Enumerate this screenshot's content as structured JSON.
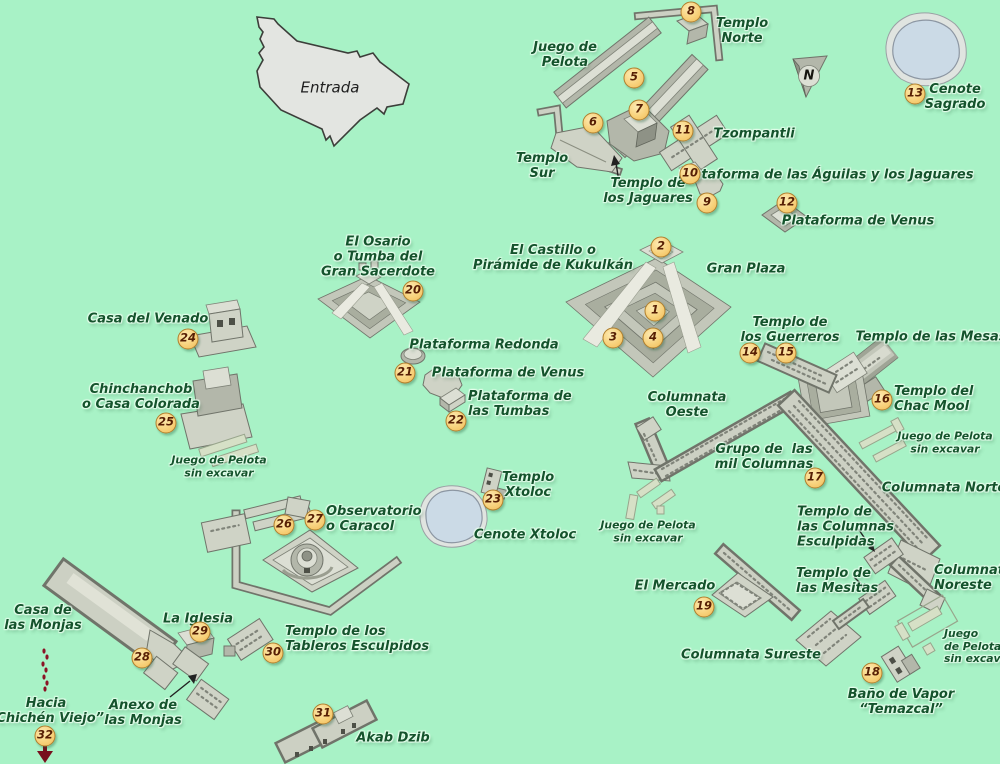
{
  "map": {
    "title": "Chichén Itzá archaeological site map",
    "background_color": "#a8f2c6",
    "label_color": "#14532c",
    "badge": {
      "fill": "#f8d27c",
      "border": "#b07f2e",
      "text_color": "#571f04"
    },
    "compass": {
      "letter": "N",
      "x": 809,
      "y": 76
    },
    "markers": [
      {
        "n": "1",
        "x": 655,
        "y": 311
      },
      {
        "n": "2",
        "x": 661,
        "y": 247
      },
      {
        "n": "3",
        "x": 613,
        "y": 338
      },
      {
        "n": "4",
        "x": 653,
        "y": 338
      },
      {
        "n": "5",
        "x": 634,
        "y": 78
      },
      {
        "n": "6",
        "x": 593,
        "y": 123
      },
      {
        "n": "7",
        "x": 639,
        "y": 110
      },
      {
        "n": "8",
        "x": 691,
        "y": 12
      },
      {
        "n": "9",
        "x": 707,
        "y": 203
      },
      {
        "n": "10",
        "x": 690,
        "y": 174
      },
      {
        "n": "11",
        "x": 683,
        "y": 131
      },
      {
        "n": "12",
        "x": 787,
        "y": 203
      },
      {
        "n": "13",
        "x": 915,
        "y": 94
      },
      {
        "n": "14",
        "x": 750,
        "y": 353
      },
      {
        "n": "15",
        "x": 786,
        "y": 353
      },
      {
        "n": "16",
        "x": 882,
        "y": 400
      },
      {
        "n": "17",
        "x": 815,
        "y": 478
      },
      {
        "n": "18",
        "x": 872,
        "y": 673
      },
      {
        "n": "19",
        "x": 704,
        "y": 607
      },
      {
        "n": "20",
        "x": 413,
        "y": 291
      },
      {
        "n": "21",
        "x": 405,
        "y": 373
      },
      {
        "n": "22",
        "x": 456,
        "y": 421
      },
      {
        "n": "23",
        "x": 493,
        "y": 500
      },
      {
        "n": "24",
        "x": 188,
        "y": 339
      },
      {
        "n": "25",
        "x": 166,
        "y": 423
      },
      {
        "n": "26",
        "x": 284,
        "y": 525
      },
      {
        "n": "27",
        "x": 315,
        "y": 520
      },
      {
        "n": "28",
        "x": 142,
        "y": 658
      },
      {
        "n": "29",
        "x": 200,
        "y": 632
      },
      {
        "n": "30",
        "x": 273,
        "y": 653
      },
      {
        "n": "31",
        "x": 323,
        "y": 714
      },
      {
        "n": "32",
        "x": 45,
        "y": 736
      }
    ],
    "labels": [
      {
        "id": "entrada",
        "text": "Entrada",
        "x": 330,
        "y": 88,
        "style": "plain"
      },
      {
        "id": "juego-de-pelota",
        "text": "Juego de\nPelota",
        "x": 565,
        "y": 55
      },
      {
        "id": "templo-norte",
        "text": "Templo\nNorte",
        "x": 742,
        "y": 31
      },
      {
        "id": "templo-sur",
        "text": "Templo\nSur",
        "x": 542,
        "y": 166
      },
      {
        "id": "templo-de-los-jaguares",
        "text": "Templo de\nlos Jaguares",
        "x": 648,
        "y": 191
      },
      {
        "id": "tzompantli",
        "text": "Tzompantli",
        "x": 754,
        "y": 134
      },
      {
        "id": "plataforma-aguilas-jaguares",
        "text": "Plataforma de las Águilas y los Jaguares",
        "x": 826,
        "y": 175
      },
      {
        "id": "plataforma-de-venus-norte",
        "text": "Plataforma de Venus",
        "x": 858,
        "y": 221
      },
      {
        "id": "cenote-sagrado",
        "text": "Cenote\nSagrado",
        "x": 955,
        "y": 97
      },
      {
        "id": "el-castillo",
        "text": "El Castillo o\nPirámide de Kukulkán",
        "x": 553,
        "y": 258
      },
      {
        "id": "gran-plaza",
        "text": "Gran Plaza",
        "x": 746,
        "y": 269
      },
      {
        "id": "el-osario",
        "text": "El Osario\no Tumba del\nGran Sacerdote",
        "x": 378,
        "y": 257
      },
      {
        "id": "casa-del-venado",
        "text": "Casa del Venado",
        "x": 148,
        "y": 319
      },
      {
        "id": "chinchanchob",
        "text": "Chinchanchob\no Casa Colorada",
        "x": 141,
        "y": 397
      },
      {
        "id": "juego-sin-excavar-oeste",
        "text": "Juego de Pelota\nsin excavar",
        "x": 219,
        "y": 467,
        "size": "small"
      },
      {
        "id": "plataforma-redonda",
        "text": "Plataforma Redonda",
        "x": 484,
        "y": 345
      },
      {
        "id": "plataforma-de-venus-centro",
        "text": "Plataforma de Venus",
        "x": 508,
        "y": 373
      },
      {
        "id": "plataforma-de-las-tumbas",
        "text": "Plataforma de\nlas Tumbas",
        "x": 468,
        "y": 404,
        "align": "left"
      },
      {
        "id": "templo-xtoloc",
        "text": "Templo\nXtoloc",
        "x": 528,
        "y": 485
      },
      {
        "id": "cenote-xtoloc",
        "text": "Cenote Xtoloc",
        "x": 525,
        "y": 535
      },
      {
        "id": "templo-de-los-guerreros",
        "text": "Templo de\nlos Guerreros",
        "x": 790,
        "y": 330
      },
      {
        "id": "templo-de-las-mesas",
        "text": "Templo de las Mesas",
        "x": 931,
        "y": 337
      },
      {
        "id": "templo-del-chac-mool",
        "text": "Templo del\nChac Mool",
        "x": 894,
        "y": 399,
        "align": "left"
      },
      {
        "id": "columnata-oeste",
        "text": "Columnata\nOeste",
        "x": 687,
        "y": 405
      },
      {
        "id": "grupo-mil-columnas",
        "text": "Grupo de  las\nmil Columnas",
        "x": 764,
        "y": 457
      },
      {
        "id": "juego-sin-excavar-este",
        "text": "Juego de Pelota\nsin excavar",
        "x": 945,
        "y": 443,
        "size": "small"
      },
      {
        "id": "columnata-norte",
        "text": "Columnata Norte",
        "x": 944,
        "y": 488
      },
      {
        "id": "templo-columnas-esculpidas",
        "text": "Templo de\nlas Columnas\nEsculpidas",
        "x": 797,
        "y": 527,
        "align": "left"
      },
      {
        "id": "juego-sin-excavar-centro",
        "text": "Juego de Pelota\nsin excavar",
        "x": 648,
        "y": 532,
        "size": "small"
      },
      {
        "id": "columnata-noreste",
        "text": "Columnata\nNoreste",
        "x": 934,
        "y": 578,
        "align": "left"
      },
      {
        "id": "templo-de-las-mesitas",
        "text": "Templo de\nlas Mesitas",
        "x": 796,
        "y": 581,
        "align": "left"
      },
      {
        "id": "el-mercado",
        "text": "El Mercado",
        "x": 675,
        "y": 586
      },
      {
        "id": "columnata-sureste",
        "text": "Columnata Sureste",
        "x": 751,
        "y": 655
      },
      {
        "id": "juego-sin-excavar-sureste",
        "text": "Juego\nde Pelota\nsin excavar",
        "x": 944,
        "y": 647,
        "align": "left",
        "size": "small"
      },
      {
        "id": "bano-de-vapor",
        "text": "Baño de Vapor\n“Temazcal”",
        "x": 901,
        "y": 702
      },
      {
        "id": "casa-de-las-monjas",
        "text": "Casa de\nlas Monjas",
        "x": 43,
        "y": 618
      },
      {
        "id": "la-iglesia",
        "text": "La Iglesia",
        "x": 198,
        "y": 619
      },
      {
        "id": "anexo-de-las-monjas",
        "text": "Anexo de\nlas Monjas",
        "x": 143,
        "y": 713
      },
      {
        "id": "templo-tableros-esculpidos",
        "text": "Templo de los\nTableros Esculpidos",
        "x": 285,
        "y": 639,
        "align": "left"
      },
      {
        "id": "observatorio",
        "text": "Observatorio\no Caracol",
        "x": 326,
        "y": 519,
        "align": "left"
      },
      {
        "id": "akab-dzib",
        "text": "Akab Dzib",
        "x": 393,
        "y": 738
      },
      {
        "id": "hacia-chichen-viejo",
        "text": "Hacia\n“Chichén Viejo”",
        "x": 46,
        "y": 711
      }
    ]
  }
}
